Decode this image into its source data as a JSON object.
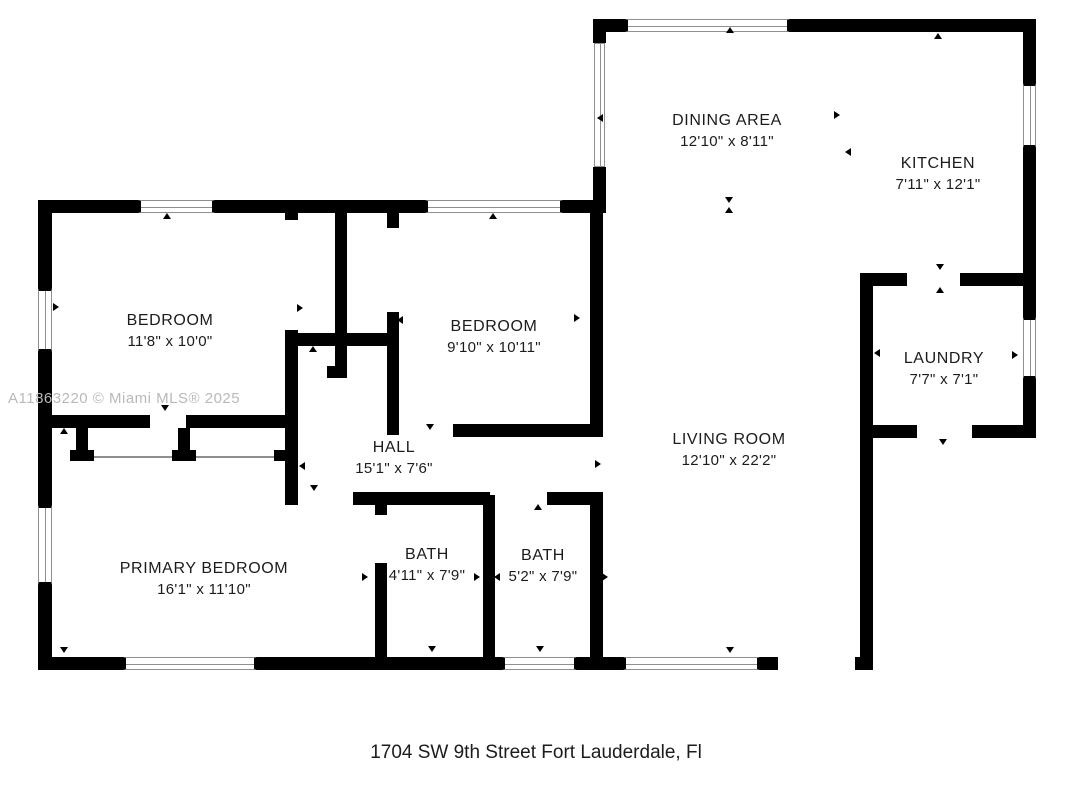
{
  "watermark": "A11863220 © Miami MLS® 2025",
  "address": "1704 SW 9th Street Fort Lauderdale, Fl",
  "colors": {
    "wall": "#000000",
    "frame": "#8f8f8f",
    "watermark": "#b9b9b9",
    "text": "#1c1c1c"
  },
  "floorplan": {
    "rooms": [
      {
        "name": "DINING AREA",
        "dims": "12'10\" x 8'11\""
      },
      {
        "name": "KITCHEN",
        "dims": "7'11\" x 12'1\""
      },
      {
        "name": "BEDROOM",
        "dims": "11'8\" x 10'0\""
      },
      {
        "name": "BEDROOM",
        "dims": "9'10\" x 10'11\""
      },
      {
        "name": "LAUNDRY",
        "dims": "7'7\" x 7'1\""
      },
      {
        "name": "HALL",
        "dims": "15'1\" x 7'6\""
      },
      {
        "name": "LIVING ROOM",
        "dims": "12'10\" x 22'2\""
      },
      {
        "name": "BATH",
        "dims": "4'11\" x 7'9\""
      },
      {
        "name": "BATH",
        "dims": "5'2\" x 7'9\""
      },
      {
        "name": "PRIMARY BEDROOM",
        "dims": "16'1\" x 11'10\""
      }
    ],
    "arrows": [
      {
        "dir": "left",
        "x": 601,
        "y": 118
      },
      {
        "dir": "up",
        "x": 730,
        "y": 31
      },
      {
        "dir": "right",
        "x": 838,
        "y": 115
      },
      {
        "dir": "left",
        "x": 849,
        "y": 152
      },
      {
        "dir": "down",
        "x": 729,
        "y": 201
      },
      {
        "dir": "up",
        "x": 729,
        "y": 211
      },
      {
        "dir": "up",
        "x": 938,
        "y": 37
      },
      {
        "dir": "down",
        "x": 940,
        "y": 268
      },
      {
        "dir": "up",
        "x": 940,
        "y": 291
      },
      {
        "dir": "left",
        "x": 878,
        "y": 353
      },
      {
        "dir": "right",
        "x": 1016,
        "y": 355
      },
      {
        "dir": "down",
        "x": 943,
        "y": 443
      },
      {
        "dir": "up",
        "x": 167,
        "y": 217
      },
      {
        "dir": "up",
        "x": 493,
        "y": 217
      },
      {
        "dir": "right",
        "x": 57,
        "y": 307
      },
      {
        "dir": "right",
        "x": 301,
        "y": 308
      },
      {
        "dir": "up",
        "x": 313,
        "y": 350
      },
      {
        "dir": "left",
        "x": 401,
        "y": 320
      },
      {
        "dir": "right",
        "x": 578,
        "y": 318
      },
      {
        "dir": "down",
        "x": 165,
        "y": 409
      },
      {
        "dir": "up",
        "x": 64,
        "y": 432
      },
      {
        "dir": "down",
        "x": 314,
        "y": 489
      },
      {
        "dir": "left",
        "x": 303,
        "y": 466
      },
      {
        "dir": "down",
        "x": 430,
        "y": 428
      },
      {
        "dir": "right",
        "x": 599,
        "y": 464
      },
      {
        "dir": "up",
        "x": 538,
        "y": 508
      },
      {
        "dir": "right",
        "x": 366,
        "y": 577
      },
      {
        "dir": "right",
        "x": 478,
        "y": 577
      },
      {
        "dir": "left",
        "x": 498,
        "y": 577
      },
      {
        "dir": "right",
        "x": 606,
        "y": 577
      },
      {
        "dir": "down",
        "x": 432,
        "y": 650
      },
      {
        "dir": "down",
        "x": 540,
        "y": 650
      },
      {
        "dir": "down",
        "x": 64,
        "y": 651
      },
      {
        "dir": "down",
        "x": 730,
        "y": 651
      }
    ]
  }
}
